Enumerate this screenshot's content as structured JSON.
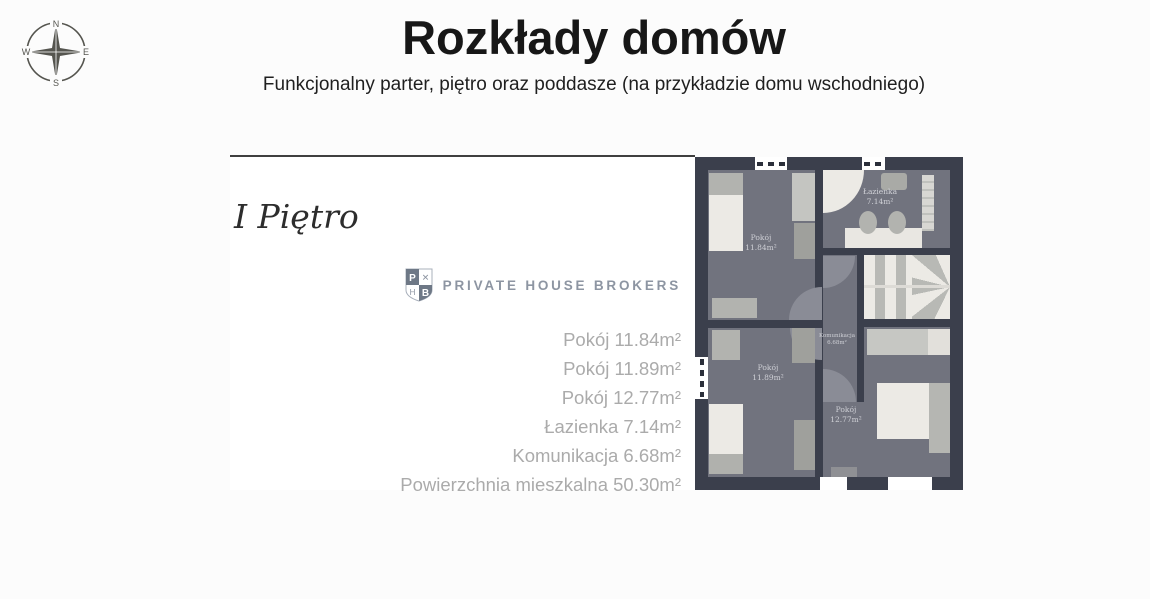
{
  "header": {
    "title": "Rozkłady domów",
    "subtitle": "Funkcjonalny parter, piętro oraz poddasze (na przykładzie domu wschodniego)",
    "compass": {
      "north": "N",
      "east": "E",
      "south": "S",
      "west": "W"
    }
  },
  "panel": {
    "floor_title": "I Piętro",
    "brand": {
      "name": "PRIVATE HOUSE BROKERS",
      "shield": {
        "tl": "P",
        "tr": "✕",
        "bl": "H",
        "br": "B"
      }
    },
    "room_list": [
      {
        "label": "Pokój 11.84m²"
      },
      {
        "label": "Pokój 11.89m²"
      },
      {
        "label": "Pokój 12.77m²"
      },
      {
        "label": "Łazienka 7.14m²"
      },
      {
        "label": "Komunikacja 6.68m²"
      },
      {
        "label": "Powierzchnia mieszkalna 50.30m²"
      }
    ]
  },
  "floorplan": {
    "rooms": [
      {
        "name": "Pokój",
        "area": "11.84m²"
      },
      {
        "name": "Łazienka",
        "area": "7.14m²"
      },
      {
        "name": "Pokój",
        "area": "11.89m²"
      },
      {
        "name": "Komunikacja",
        "area": "6.68m²"
      },
      {
        "name": "Pokój",
        "area": "12.77m²"
      }
    ],
    "colors": {
      "wall": "#3b3f4c",
      "floor": "#71737e",
      "furniture_light": "#eceae5",
      "furniture_gray": "#b2b3af",
      "door_arc": "#8a8c96",
      "label": "#cfd0d6"
    }
  }
}
